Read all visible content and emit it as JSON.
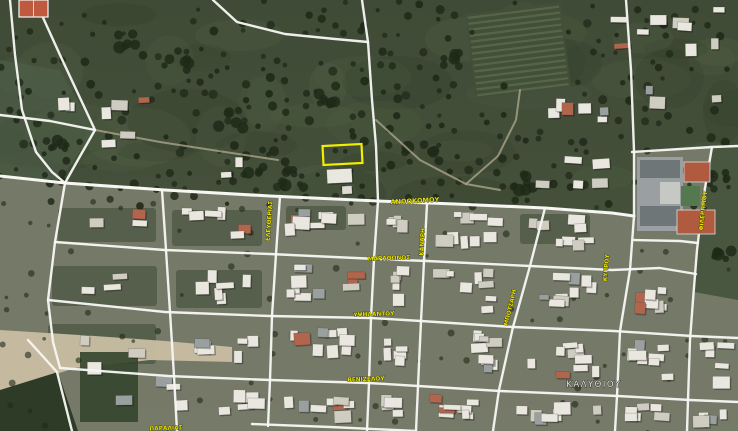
{
  "app": {
    "view_type": "satellite-map",
    "accent_color": "#f2ee00",
    "road_color": "#f6f6f2",
    "label_color": "#e8e000"
  },
  "map": {
    "place_label": {
      "text": "ΚΑΛΥΘΙΟΥ",
      "x": 594,
      "y": 387,
      "size": 8.5,
      "color": "#e4e4df"
    },
    "street_labels": [
      {
        "text": "ΑΝΘΟΚΟΜΟΥ",
        "x": 415,
        "y": 203,
        "rot": -3,
        "size": 6.5
      },
      {
        "text": "ΕΛΕΥΘΕΡΙΑΣ",
        "x": 271,
        "y": 221,
        "rot": -86,
        "size": 5.8
      },
      {
        "text": "ΜΑΡΑΘΩΝΟΣ",
        "x": 389,
        "y": 260,
        "rot": -2,
        "size": 5.8
      },
      {
        "text": "ΥΨΗΛΑΝΤΟΥ",
        "x": 374,
        "y": 316,
        "rot": -2,
        "size": 5.8
      },
      {
        "text": "ΒΕΝΙΖΕΛΟΥ",
        "x": 366,
        "y": 381,
        "rot": -2,
        "size": 5.8
      },
      {
        "text": "ΚΑΝΑΡΗ",
        "x": 424,
        "y": 242,
        "rot": -87,
        "size": 5.8
      },
      {
        "text": "ΜΠΟΤΣΑΡΗ",
        "x": 512,
        "y": 308,
        "rot": -76,
        "size": 5.8
      },
      {
        "text": "ΚΥΠΡΟΥ",
        "x": 608,
        "y": 268,
        "rot": -85,
        "size": 5.8
      },
      {
        "text": "ΦΙΛΕΡΗΜΟΥ",
        "x": 705,
        "y": 211,
        "rot": -84,
        "size": 5.8
      },
      {
        "text": "ΠΑΡΑΛΙΑΣ",
        "x": 166,
        "y": 430,
        "rot": -2,
        "size": 5.8
      }
    ],
    "highlight_parcel": {
      "x": 323,
      "y": 145,
      "w": 39,
      "h": 19,
      "rot": -3,
      "color": "#f2ee00",
      "stroke_width": 2.2
    },
    "roads": {
      "main": [
        [
          [
            0,
            176
          ],
          [
            65,
            183
          ],
          [
            165,
            190
          ],
          [
            270,
            196
          ],
          [
            378,
            201
          ],
          [
            455,
            204
          ],
          [
            545,
            208
          ],
          [
            612,
            213
          ],
          [
            634,
            216
          ]
        ]
      ],
      "secondary": [
        [
          [
            55,
            242
          ],
          [
            165,
            250
          ],
          [
            270,
            254
          ],
          [
            377,
            259
          ],
          [
            427,
            261
          ],
          [
            530,
            266
          ],
          [
            612,
            270
          ],
          [
            660,
            268
          ],
          [
            696,
            274
          ]
        ],
        [
          [
            48,
            300
          ],
          [
            165,
            312
          ],
          [
            270,
            316
          ],
          [
            371,
            318
          ],
          [
            421,
            321
          ],
          [
            513,
            327
          ],
          [
            614,
            331
          ],
          [
            692,
            336
          ],
          [
            738,
            338
          ]
        ],
        [
          [
            60,
            368
          ],
          [
            168,
            376
          ],
          [
            270,
            380
          ],
          [
            369,
            383
          ],
          [
            418,
            386
          ],
          [
            500,
            391
          ],
          [
            618,
            396
          ],
          [
            690,
            400
          ],
          [
            738,
            402
          ]
        ],
        [
          [
            252,
            424
          ],
          [
            330,
            427
          ],
          [
            416,
            431
          ]
        ],
        [
          [
            162,
            190
          ],
          [
            166,
            250
          ],
          [
            170,
            312
          ],
          [
            174,
            376
          ],
          [
            177,
            431
          ]
        ],
        [
          [
            280,
            196
          ],
          [
            276,
            254
          ],
          [
            272,
            316
          ],
          [
            270,
            380
          ],
          [
            268,
            426
          ]
        ],
        [
          [
            362,
            0
          ],
          [
            368,
            42
          ],
          [
            372,
            100
          ],
          [
            376,
            146
          ],
          [
            378,
            201
          ],
          [
            374,
            259
          ],
          [
            371,
            318
          ],
          [
            369,
            383
          ],
          [
            367,
            431
          ]
        ],
        [
          [
            213,
            0
          ],
          [
            237,
            22
          ],
          [
            285,
            34
          ],
          [
            335,
            39
          ],
          [
            368,
            42
          ]
        ],
        [
          [
            427,
            204
          ],
          [
            424,
            261
          ],
          [
            421,
            321
          ],
          [
            418,
            386
          ],
          [
            416,
            431
          ]
        ],
        [
          [
            545,
            208
          ],
          [
            530,
            266
          ],
          [
            513,
            327
          ],
          [
            499,
            390
          ],
          [
            493,
            431
          ]
        ],
        [
          [
            626,
            0
          ],
          [
            631,
            70
          ],
          [
            634,
            151
          ],
          [
            634,
            216
          ],
          [
            630,
            270
          ],
          [
            620,
            331
          ],
          [
            617,
            396
          ],
          [
            615,
            431
          ]
        ],
        [
          [
            632,
            152
          ],
          [
            712,
            147
          ],
          [
            738,
            146
          ]
        ],
        [
          [
            712,
            147
          ],
          [
            703,
            200
          ],
          [
            697,
            250
          ],
          [
            693,
            300
          ],
          [
            690,
            340
          ],
          [
            688,
            400
          ],
          [
            687,
            431
          ]
        ],
        [
          [
            634,
            240
          ],
          [
            680,
            241
          ],
          [
            698,
            243
          ]
        ],
        [
          [
            10,
            0
          ],
          [
            15,
            55
          ],
          [
            22,
            110
          ],
          [
            36,
            152
          ],
          [
            52,
            172
          ],
          [
            65,
            183
          ]
        ],
        [
          [
            35,
            0
          ],
          [
            60,
            55
          ],
          [
            95,
            130
          ],
          [
            79,
            158
          ],
          [
            65,
            183
          ]
        ],
        [
          [
            0,
            115
          ],
          [
            50,
            121
          ],
          [
            95,
            130
          ]
        ],
        [
          [
            65,
            183
          ],
          [
            55,
            242
          ],
          [
            48,
            300
          ],
          [
            53,
            342
          ],
          [
            60,
            368
          ]
        ],
        [
          [
            28,
            340
          ],
          [
            57,
            372
          ],
          [
            72,
            431
          ]
        ]
      ],
      "dirt_paths": [
        [
          [
            376,
            120
          ],
          [
            420,
            160
          ],
          [
            466,
            184
          ],
          [
            500,
            190
          ]
        ],
        [
          [
            466,
            184
          ],
          [
            498,
            156
          ],
          [
            516,
            120
          ],
          [
            520,
            90
          ]
        ],
        [
          [
            95,
            130
          ],
          [
            160,
            142
          ],
          [
            225,
            152
          ],
          [
            278,
            160
          ]
        ]
      ]
    },
    "features": {
      "school_complex": {
        "x": 637,
        "y": 157,
        "roof_color": "#9aa0a2",
        "court_red": "#b05a40",
        "court_green": "#55794f"
      },
      "sports_court_topleft": {
        "x": 19,
        "y": 0,
        "w": 29,
        "h": 17,
        "color": "#bf5a3e"
      }
    }
  }
}
